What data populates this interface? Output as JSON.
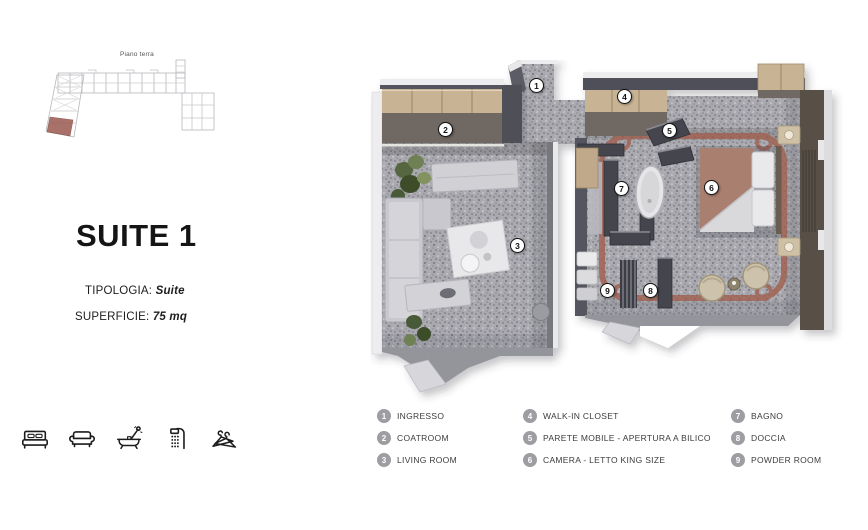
{
  "site_plan": {
    "label": "Piano terra"
  },
  "info": {
    "title": "SUITE 1",
    "tipologia_label": "TIPOLOGIA: ",
    "tipologia_value": "Suite",
    "superficie_label": "SUPERFICIE: ",
    "superficie_value": "75 mq"
  },
  "amenities": {
    "icons": [
      "bed",
      "sofa",
      "bathtub",
      "shower",
      "hangers"
    ]
  },
  "plan": {
    "markers": [
      "1",
      "2",
      "3",
      "4",
      "5",
      "6",
      "7",
      "8",
      "9"
    ]
  },
  "legend": {
    "columns": [
      {
        "items": [
          {
            "n": "1",
            "label": "INGRESSO"
          },
          {
            "n": "2",
            "label": "COATROOM"
          },
          {
            "n": "3",
            "label": "LIVING ROOM"
          }
        ]
      },
      {
        "items": [
          {
            "n": "4",
            "label": "WALK-IN CLOSET"
          },
          {
            "n": "5",
            "label": "PARETE MOBILE -  APERTURA A BILICO"
          },
          {
            "n": "6",
            "label": "CAMERA - LETTO KING SIZE"
          }
        ]
      },
      {
        "items": [
          {
            "n": "7",
            "label": "BAGNO"
          },
          {
            "n": "8",
            "label": "DOCCIA"
          },
          {
            "n": "9",
            "label": "POWDER ROOM"
          }
        ]
      }
    ]
  },
  "colors": {
    "accent_red": "#a2604f",
    "floor_gray": "#a9a9af",
    "wall_dark": "#50505a",
    "cabinet_tan": "#c8b394",
    "bed_mauve": "#a97f6f",
    "legend_badge_gray": "#9d9da2"
  }
}
